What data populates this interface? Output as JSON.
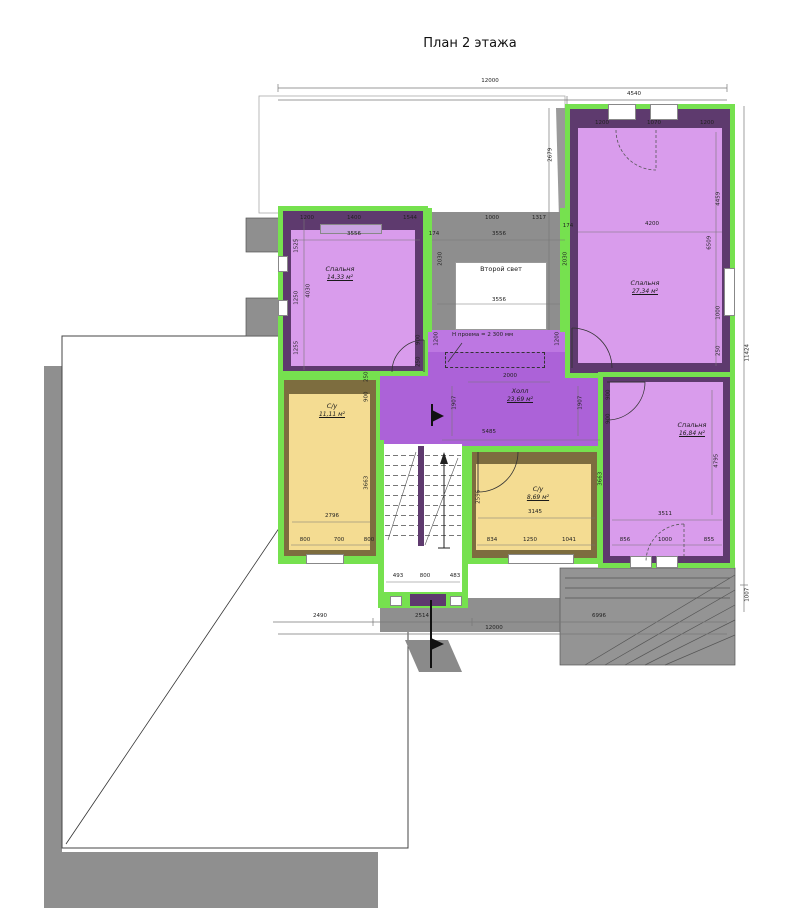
{
  "title": "План 2 этажа",
  "annotations": {
    "opening_height": "Н проема = 2 300 мм"
  },
  "rooms": {
    "bedroom1": {
      "name": "Спальня",
      "area": "14,33 м²"
    },
    "bedroom2": {
      "name": "Спальня",
      "area": "27,34 м²"
    },
    "bedroom3": {
      "name": "Спальня",
      "area": "16,84 м²"
    },
    "hall": {
      "name": "Холл",
      "area": "23,69 м²"
    },
    "wc1": {
      "name": "С/у",
      "area": "11,11 м²"
    },
    "wc2": {
      "name": "С/у",
      "area": "8,69 м²"
    },
    "void": {
      "name": "Второй свет"
    }
  },
  "dims": {
    "top_total": "12000",
    "top_right": "4540",
    "bottom_left": "2490",
    "bottom_mid": "2514",
    "bottom_right": "6996",
    "bottom_total": "12000",
    "right_total": "11424",
    "right_seg": "1007",
    "bl_top_1": "1200",
    "bl_top_2": "1400",
    "bl_top_3": "1544",
    "bl_width": "3556",
    "bl_left_1": "1525",
    "bl_left_2": "1250",
    "bl_left_3": "1255",
    "bl_left_total": "4030",
    "bl_door": "900",
    "bl_door2": "250",
    "sl_top_1": "1000",
    "sl_top_2": "1317",
    "sl_width_top": "3556",
    "sl_width_bottom": "3556",
    "sl_side_left": "2030",
    "sl_side_right": "2030",
    "sl_wall_left": "174",
    "sl_wall_right": "174",
    "tr_top_1": "1200",
    "tr_top_2": "1070",
    "tr_top_3": "1200",
    "tr_mid": "4200",
    "tr_right_1": "4459",
    "tr_right_2": "6509",
    "tr_right_3": "1000",
    "tr_right_4": "250",
    "tr_left_edge": "2679",
    "hall_top": "2000",
    "hall_width": "5485",
    "hall_left": "1907",
    "hall_right": "1907",
    "hall_open_left": "1200",
    "hall_open_right": "1200",
    "hall_door": "900",
    "wc1_width": "2796",
    "wc1_b1": "800",
    "wc1_b2": "700",
    "wc1_b3": "800",
    "wc1_right": "3663",
    "wc1_top": "900",
    "wc1_small": "250",
    "wc2_width": "3145",
    "wc2_b1": "834",
    "wc2_b2": "1250",
    "wc2_b3": "1041",
    "wc2_left": "2596",
    "br_width": "3511",
    "br_b1": "856",
    "br_b2": "1000",
    "br_b3": "855",
    "br_right": "4795",
    "br_left": "3663",
    "br_door": "900",
    "st_b1": "493",
    "st_b2": "800",
    "st_b3": "483"
  },
  "colors": {
    "wall_highlight_green": "#76E14F",
    "room_fill_purple": "#D99CEC",
    "hall_fill_purple": "#AC62D8",
    "wall_dark_purple": "#5E3A6E",
    "room_fill_yellow": "#F4DC92",
    "wall_olive": "#7D6D3F",
    "roof_gray": "#8F8F8F"
  }
}
